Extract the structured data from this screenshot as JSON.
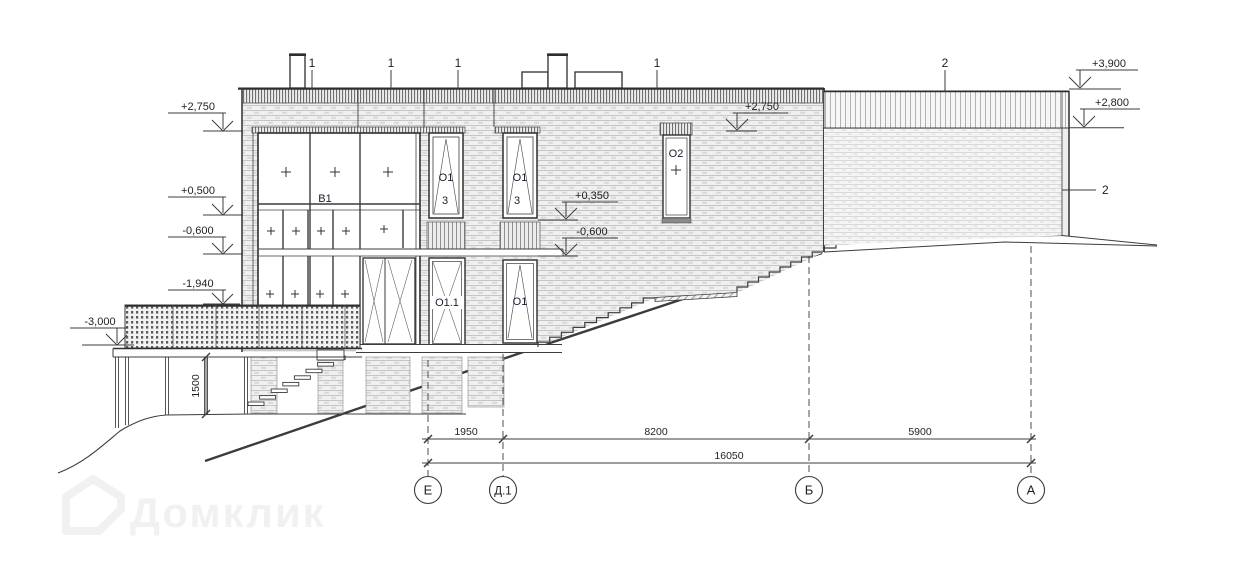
{
  "axes": {
    "top": [
      "1",
      "1",
      "1",
      "1",
      "2"
    ],
    "bottom": [
      "Е",
      "Д.1",
      "Б",
      "А"
    ]
  },
  "levels": {
    "l2750": "+2,750",
    "l0500": "+0,500",
    "lm0600": "-0,600",
    "lm1940": "-1,940",
    "lm3000": "-3,000",
    "r3900": "+3,900",
    "r2800": "+2,800",
    "i2750": "+2,750",
    "i0350": "+0,350",
    "im0600": "-0,600"
  },
  "dims": {
    "d1950": "1950",
    "d8200": "8200",
    "d5900": "5900",
    "total": "16050",
    "h1500": "1500"
  },
  "marks": {
    "b1": "В1",
    "o1": "О1",
    "o1n": "3",
    "o11": "О1.1",
    "o2": "О2",
    "wall2": "2"
  },
  "watermark": "Домклик"
}
